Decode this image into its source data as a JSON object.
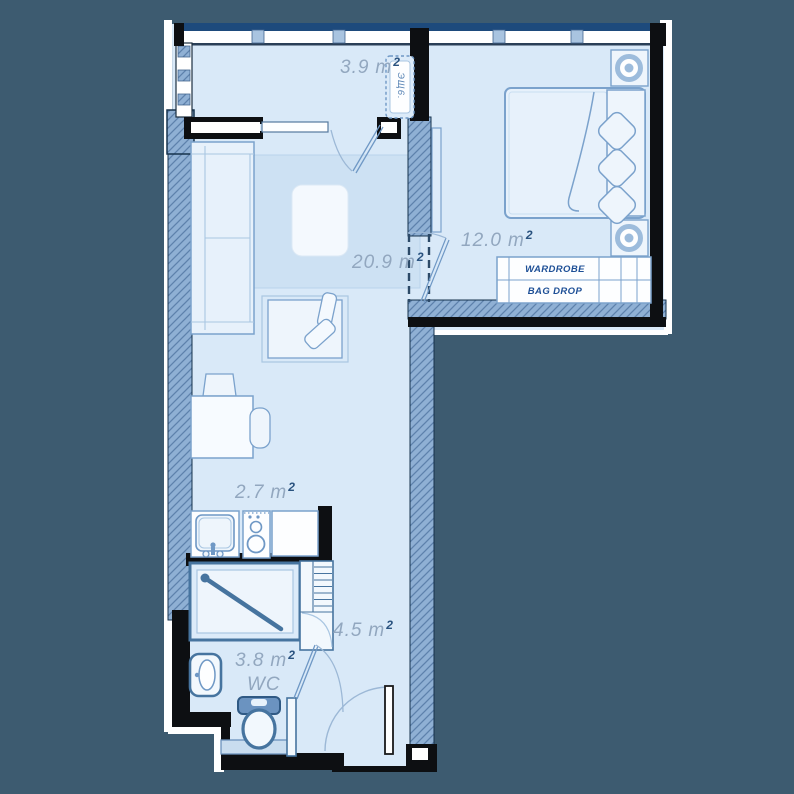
{
  "title": "studio-apartment-floor-plan",
  "colors": {
    "background": "#3d5b70",
    "floor": "#d9e9f8",
    "rug": "#cde1f3",
    "wall": "#0d0f12",
    "glazing": "#1d4a7c",
    "hatch_fill": "#8fb0d4",
    "hatch_line": "#5d81ac",
    "stroke": "#6f98c5",
    "stroke_strong": "#46749f",
    "label": "#92a7bf",
    "label_sup": "#29527f",
    "text_navy": "#1d4f96"
  },
  "rooms": [
    {
      "id": "balcony",
      "area": "3.9",
      "unit": "m",
      "sup": "2"
    },
    {
      "id": "bedroom",
      "area": "12.0",
      "unit": "m",
      "sup": "2"
    },
    {
      "id": "living-room",
      "area": "20.9",
      "unit": "m",
      "sup": "2"
    },
    {
      "id": "kitchen",
      "area": "2.7",
      "unit": "m",
      "sup": "2"
    },
    {
      "id": "hallway",
      "area": "4.5",
      "unit": "m",
      "sup": "2"
    },
    {
      "id": "bathroom",
      "area": "3.8",
      "unit": "m",
      "sup": "2",
      "name": "WC"
    }
  ],
  "furniture_labels": {
    "wardrobe": "WARDROBE",
    "bag_drop": "BAG DROP",
    "balcony_cabinet": "ЭЩ6."
  }
}
